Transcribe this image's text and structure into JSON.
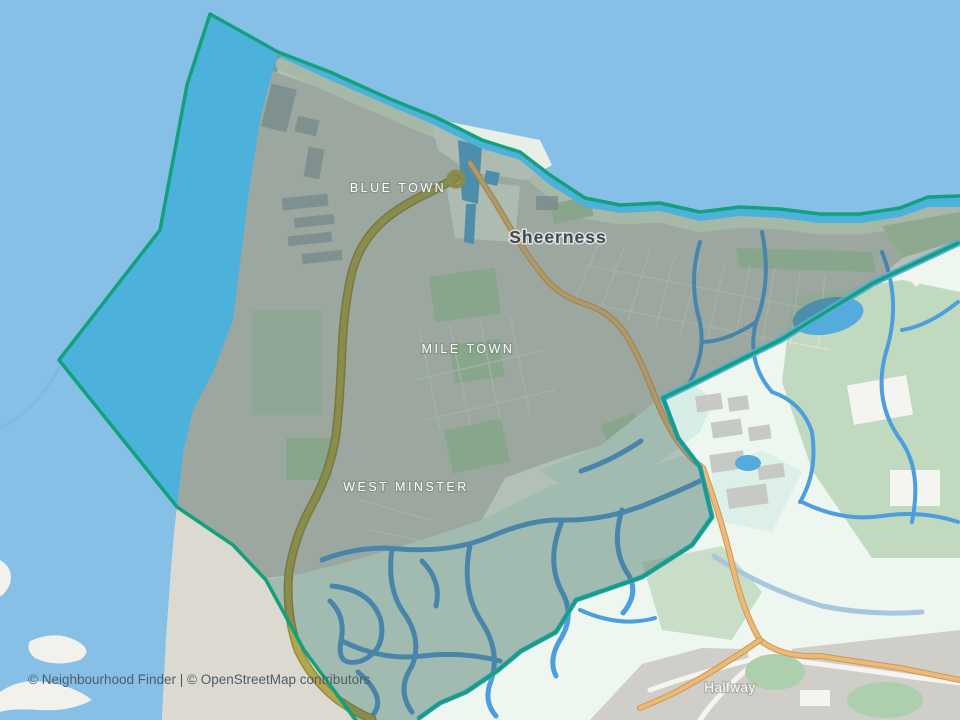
{
  "map": {
    "labels": {
      "city": "Sheerness",
      "blue_town": "BLUE TOWN",
      "mile_town": "MILE TOWN",
      "west_minster": "WEST MINSTER",
      "halfway": "Halfway"
    },
    "attribution": "© Neighbourhood Finder | © OpenStreetMap contributors",
    "colors": {
      "sea": "#86c0e7",
      "seaArm": "#79b6e2",
      "seaInside": "#4cb2dc",
      "boundary": "#13a07d",
      "tint": "rgba(62,88,74,0.34)",
      "land": "#eef6f0",
      "urban": "#cbd1cb",
      "marsh": "#d7eee6",
      "beach": "#dcd9d1",
      "field": "#b9d4b5",
      "green": "#aecfae",
      "ditch": "#4d9edd",
      "pond": "#55abdc",
      "canal": "#58aedd",
      "channel": "#a8c6de",
      "roadA": "#b2a74d",
      "roadACase": "#958a3d",
      "roadB": "#ecb979",
      "roadBCase": "#cb9854",
      "grayUrban": "#cfcec8",
      "building": "#9aa8b2",
      "industry": "#c6c9c4",
      "port": "#e9efe7",
      "street": "#dde4dc",
      "islet": "#f2f1ec",
      "white": "#f4f4f1",
      "labelDark": "#3d4852",
      "labelLight": "#fbfdfc",
      "attr": "#4f5d66"
    }
  }
}
